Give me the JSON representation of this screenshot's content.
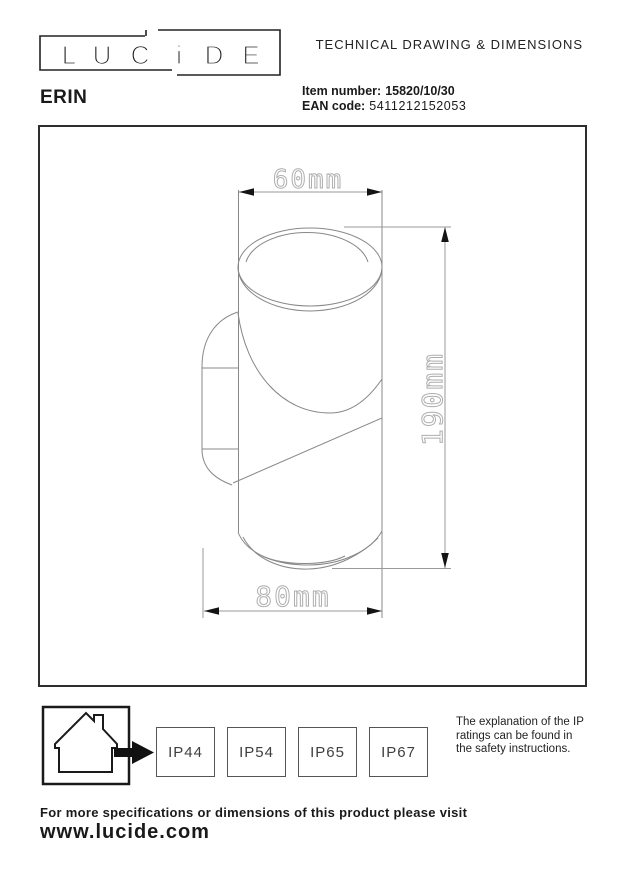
{
  "header": {
    "logo_letters": [
      "L",
      "U",
      "C",
      "i",
      "D",
      "E"
    ],
    "doc_title": "TECHNICAL DRAWING & DIMENSIONS",
    "product_name": "ERIN",
    "item_number_label": "Item number:",
    "item_number_value": "15820/10/30",
    "ean_label": "EAN code:",
    "ean_value": "5411212152053"
  },
  "drawing": {
    "type": "technical line drawing of cylindrical up/down wall light, side view with wall bracket",
    "dim_width_top": "60mm",
    "dim_height": "190mm",
    "dim_width_bottom": "80mm"
  },
  "footer": {
    "ip_ratings": [
      "IP44",
      "IP54",
      "IP65",
      "IP67"
    ],
    "ip_note": "The explanation of the IP ratings can be found in the safety instructions.",
    "more_info_text": "For more specifications or dimensions of this product please visit",
    "website": "www.lucide.com"
  },
  "colors": {
    "ink": "#1a1a1a",
    "frame": "#2e2e2e",
    "lamp_line": "#888888",
    "dim_line": "#9a9a9a",
    "dim_text": "#aeaeae"
  }
}
